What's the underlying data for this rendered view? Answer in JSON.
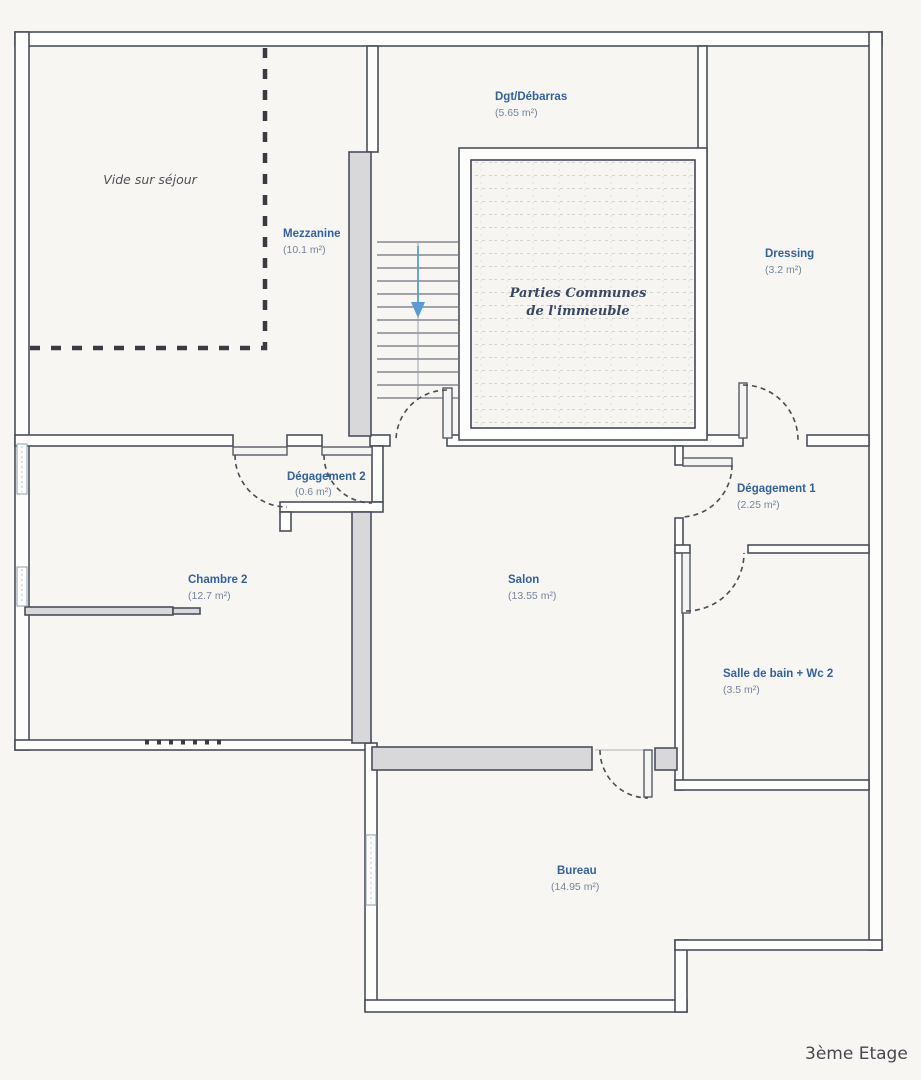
{
  "plan": {
    "floor_label": "3ème Etage",
    "void_annotation": "Vide sur séjour",
    "common_area": {
      "line1": "Parties Communes",
      "line2": "de l'immeuble"
    },
    "rooms": {
      "dgt_debarras": {
        "name": "Dgt/Débarras",
        "area": "(5.65 m²)"
      },
      "mezzanine": {
        "name": "Mezzanine",
        "area": "(10.1 m²)"
      },
      "dressing": {
        "name": "Dressing",
        "area": "(3.2 m²)"
      },
      "degagement2": {
        "name": "Dégagement 2",
        "area": "(0.6 m²)"
      },
      "degagement1": {
        "name": "Dégagement 1",
        "area": "(2.25 m²)"
      },
      "chambre2": {
        "name": "Chambre 2",
        "area": "(12.7 m²)"
      },
      "salon": {
        "name": "Salon",
        "area": "(13.55 m²)"
      },
      "salle_de_bain": {
        "name": "Salle de bain + Wc 2",
        "area": "(3.5 m²)"
      },
      "bureau": {
        "name": "Bureau",
        "area": "(14.95 m²)"
      }
    },
    "colors": {
      "room_name_blue": "#33619e",
      "room_area_gray": "#76839b",
      "wall_line": "#4b4f5a",
      "gray_wall_fill": "#d8d8da",
      "stairs_arrow_blue": "#5b9bd5",
      "paper": "#f7f6f3"
    }
  }
}
